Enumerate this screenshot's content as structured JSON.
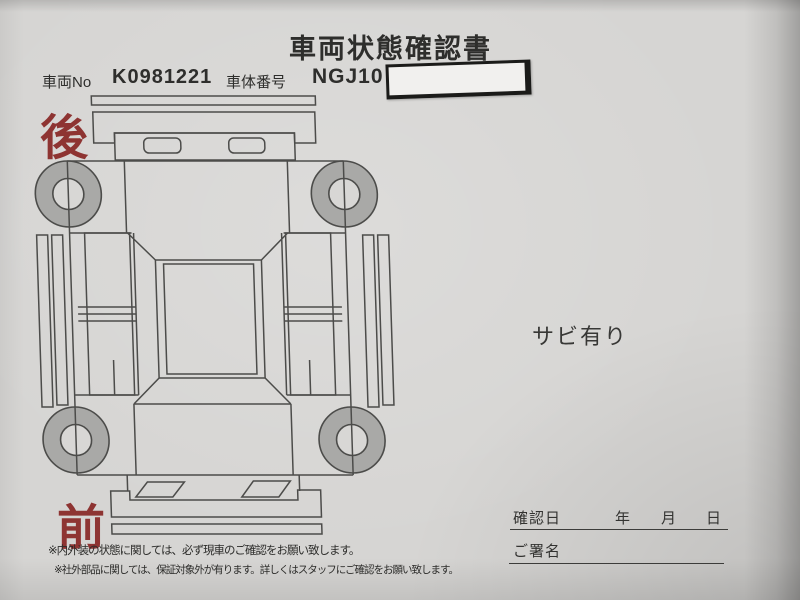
{
  "document": {
    "title": "車両状態確認書",
    "vehicle_no_label": "車両No",
    "vehicle_no_value": "K0981221",
    "body_number_label": "車体番号",
    "body_number_value": "NGJ10",
    "masked_area": "white-tape-over-body-number",
    "rear_label": "後",
    "front_label": "前",
    "condition_note": "サビ有り",
    "confirmation": {
      "date_label": "確認日",
      "year_label": "年",
      "month_label": "月",
      "day_label": "日",
      "signature_label": "ご署名"
    },
    "footnotes": [
      "※内外装の状態に関しては、必ず現車のご確認をお願い致します。",
      "※社外部品に関しては、保証対象外が有ります。詳しくはスタッフにご確認をお願い致します。"
    ],
    "diagram": "car-top-view-development-drawing",
    "colors": {
      "paper": "#d6d5d3",
      "ink": "#2e2e2c",
      "line": "#4c4c4a",
      "accent_red": "#8e3432",
      "wheel_fill": "#a9a9a7",
      "tape_fill": "#f1f0ee",
      "tape_border": "#1b1b19"
    }
  }
}
